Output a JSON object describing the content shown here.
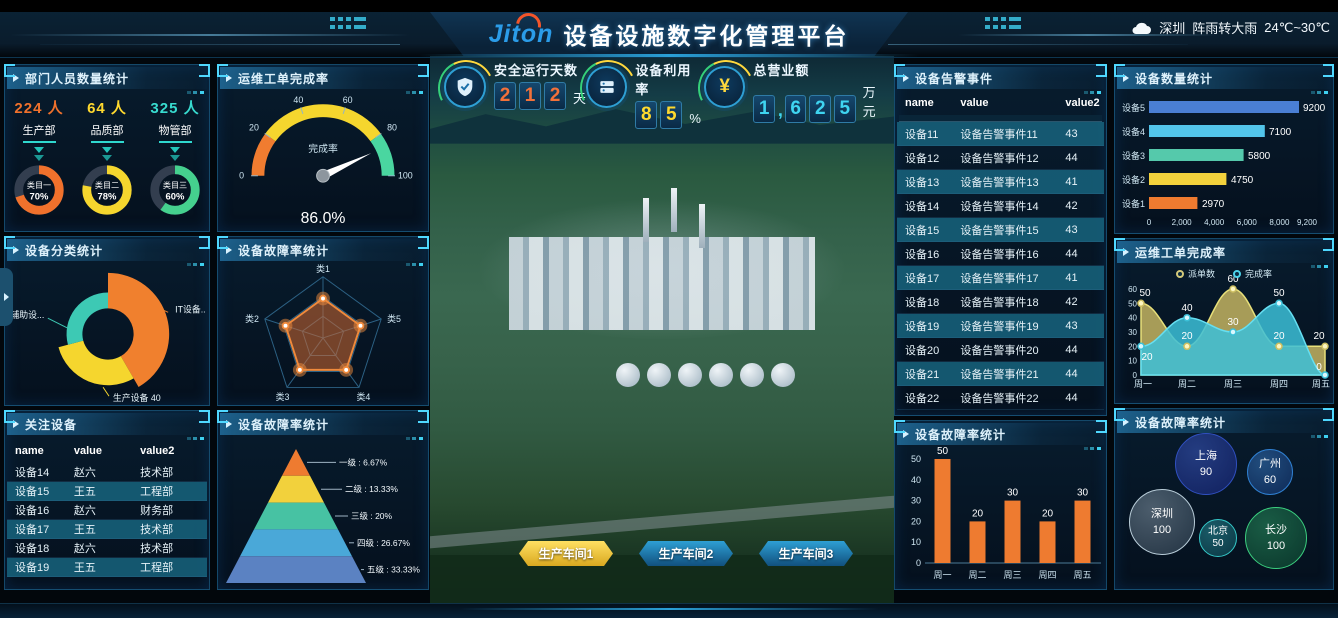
{
  "header": {
    "logo": {
      "part1": "Jit",
      "part2": "o",
      "part3": "n"
    },
    "title": "设备设施数字化管理平台",
    "weather": {
      "city": "深圳",
      "condition": "阵雨转大雨",
      "temp": "24℃~30℃"
    }
  },
  "kpis": {
    "safety": {
      "label": "安全运行天数",
      "d1": "2",
      "d2": "1",
      "d3": "2",
      "unit": "天"
    },
    "utilization": {
      "label": "设备利用率",
      "d1": "8",
      "d2": "5",
      "unit": "%"
    },
    "revenue": {
      "label": "总营业额",
      "d1": "1",
      "comma": ",",
      "d2": "6",
      "d3": "2",
      "d4": "5",
      "unit": "万元"
    }
  },
  "workshops": {
    "b1": "生产车间1",
    "b2": "生产车间2",
    "b3": "生产车间3"
  },
  "dept_panel": {
    "title": "部门人员数量统计",
    "stats": [
      {
        "count": "224 人",
        "dept": "生产部"
      },
      {
        "count": "64 人",
        "dept": "品质部"
      },
      {
        "count": "325 人",
        "dept": "物管部"
      }
    ],
    "chart_data": {
      "type": "pie",
      "items": [
        {
          "label": "类目一",
          "pct": "70%",
          "value": 70
        },
        {
          "label": "类目二",
          "pct": "78%",
          "value": 78
        },
        {
          "label": "类目三",
          "pct": "60%",
          "value": 60
        }
      ]
    }
  },
  "category_panel": {
    "title": "设备分类统计",
    "label_aux": "辅助设...",
    "label_it": "IT设备..",
    "label_prod": "生产设备 40"
  },
  "focus_panel": {
    "title": "关注设备",
    "headers": [
      "name",
      "value",
      "value2"
    ],
    "rows": [
      [
        "设备14",
        "赵六",
        "技术部"
      ],
      [
        "设备15",
        "王五",
        "工程部"
      ],
      [
        "设备16",
        "赵六",
        "财务部"
      ],
      [
        "设备17",
        "王五",
        "技术部"
      ],
      [
        "设备18",
        "赵六",
        "技术部"
      ],
      [
        "设备19",
        "王五",
        "工程部"
      ]
    ]
  },
  "gauge_panel": {
    "title": "运维工单完成率",
    "center_label": "完成率",
    "value": "86.0%",
    "ticks": [
      "0",
      "20",
      "40",
      "60",
      "80",
      "100"
    ]
  },
  "radar_panel": {
    "title": "设备故障率统计",
    "axes": [
      "类1",
      "类2",
      "类3",
      "类4",
      "类5"
    ]
  },
  "pyramid_panel": {
    "title": "设备故障率统计",
    "levels": [
      "一级 : 6.67%",
      "二级 : 13.33%",
      "三级 : 20%",
      "四级 : 26.67%",
      "五级 : 33.33%"
    ]
  },
  "alarm_panel": {
    "title": "设备告警事件",
    "headers": [
      "name",
      "value",
      "value2"
    ],
    "rows": [
      [
        "设备11",
        "设备告警事件11",
        "43"
      ],
      [
        "设备12",
        "设备告警事件12",
        "44"
      ],
      [
        "设备13",
        "设备告警事件13",
        "41"
      ],
      [
        "设备14",
        "设备告警事件14",
        "42"
      ],
      [
        "设备15",
        "设备告警事件15",
        "43"
      ],
      [
        "设备16",
        "设备告警事件16",
        "44"
      ],
      [
        "设备17",
        "设备告警事件17",
        "41"
      ],
      [
        "设备18",
        "设备告警事件18",
        "42"
      ],
      [
        "设备19",
        "设备告警事件19",
        "43"
      ],
      [
        "设备20",
        "设备告警事件20",
        "44"
      ],
      [
        "设备21",
        "设备告警事件21",
        "44"
      ],
      [
        "设备22",
        "设备告警事件22",
        "44"
      ]
    ]
  },
  "fault_bar_panel": {
    "title": "设备故障率统计",
    "chart_data": {
      "type": "bar",
      "categories": [
        "周一",
        "周二",
        "周三",
        "周四",
        "周五"
      ],
      "values": [
        50,
        20,
        30,
        20,
        30
      ],
      "yticks": [
        "0",
        "10",
        "20",
        "30",
        "40",
        "50"
      ],
      "ylim": [
        0,
        50
      ]
    }
  },
  "device_count_panel": {
    "title": "设备数量统计",
    "chart_data": {
      "type": "bar",
      "orientation": "horizontal",
      "categories": [
        "设备1",
        "设备2",
        "设备3",
        "设备4",
        "设备5"
      ],
      "values": [
        2970,
        4750,
        5800,
        7100,
        9200
      ],
      "xticks": [
        "0",
        "2,000",
        "4,000",
        "6,000",
        "8,000",
        "9,200"
      ],
      "xlim": [
        0,
        9200
      ]
    }
  },
  "completion_panel": {
    "title": "运维工单完成率",
    "chart_data": {
      "type": "area",
      "categories": [
        "周一",
        "周二",
        "周三",
        "周四",
        "周五"
      ],
      "legend": [
        "派单数",
        "完成率"
      ],
      "series": [
        {
          "name": "派单数",
          "values": [
            50,
            20,
            60,
            20,
            20
          ]
        },
        {
          "name": "完成率",
          "values": [
            20,
            40,
            30,
            50,
            0
          ]
        }
      ],
      "yticks": [
        "0",
        "10",
        "20",
        "30",
        "40",
        "50",
        "60"
      ],
      "ylim": [
        0,
        60
      ]
    }
  },
  "bubble_panel": {
    "title": "设备故障率统计",
    "items": [
      {
        "city": "上海",
        "value": "90"
      },
      {
        "city": "广州",
        "value": "60"
      },
      {
        "city": "深圳",
        "value": "100"
      },
      {
        "city": "北京",
        "value": "50"
      },
      {
        "city": "长沙",
        "value": "100"
      }
    ]
  }
}
